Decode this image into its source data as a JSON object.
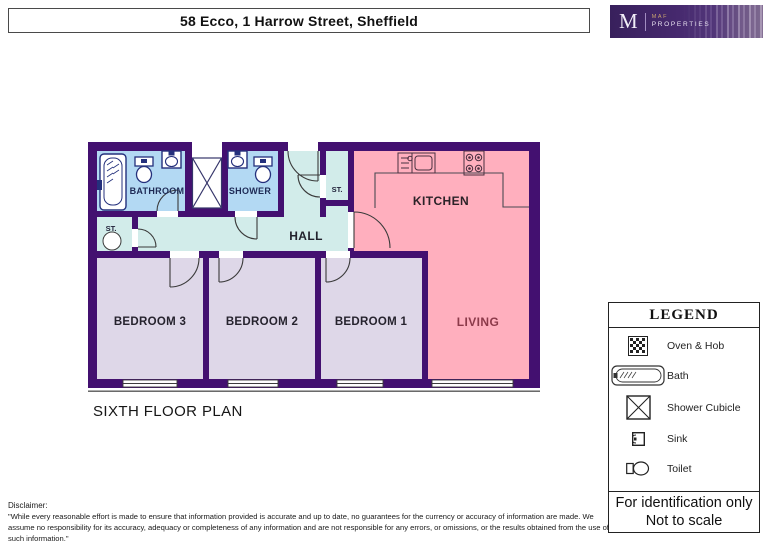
{
  "header": {
    "title": "58 Ecco, 1 Harrow Street, Sheffield"
  },
  "logo": {
    "monogram": "M",
    "brand_line1": "MAF",
    "brand_line2": "PROPERTIES"
  },
  "plan": {
    "floor_label": "SIXTH FLOOR PLAN",
    "rooms": {
      "bathroom": "BATHROOM",
      "shower": "SHOWER",
      "st_top": "ST.",
      "st_left": "ST.",
      "hall": "HALL",
      "kitchen": "KITCHEN",
      "bedroom3": "BEDROOM 3",
      "bedroom2": "BEDROOM 2",
      "bedroom1": "BEDROOM 1",
      "living": "LIVING"
    }
  },
  "legend": {
    "title": "LEGEND",
    "items": [
      {
        "icon": "oven-hob-icon",
        "label": "Oven & Hob"
      },
      {
        "icon": "bath-icon",
        "label": "Bath"
      },
      {
        "icon": "shower-cubicle-icon",
        "label": "Shower Cubicle"
      },
      {
        "icon": "sink-icon",
        "label": "Sink"
      },
      {
        "icon": "toilet-icon",
        "label": "Toilet"
      }
    ],
    "footer_line1": "For identification only",
    "footer_line2": "Not to scale"
  },
  "disclaimer": {
    "label": "Disclaimer:",
    "text": "\"While every reasonable effort is made to ensure that information provided is accurate and up to date, no guarantees for the currency or accuracy of information are made. We assume no responsibility for its accuracy, adequacy or completeness of any information and are not responsible for any errors, or omissions, or the results obtained from the use of such information.\""
  },
  "colors": {
    "wall": "#431070",
    "bathroom_fill": "#b3d9f3",
    "hall_fill": "#d2ecea",
    "bedroom_fill": "#ded7e8",
    "kitchen_living_fill": "#ffafbe",
    "fixture_outline": "#24307c",
    "living_label": "#8c3a4a",
    "logo_purple": "#46296e"
  }
}
